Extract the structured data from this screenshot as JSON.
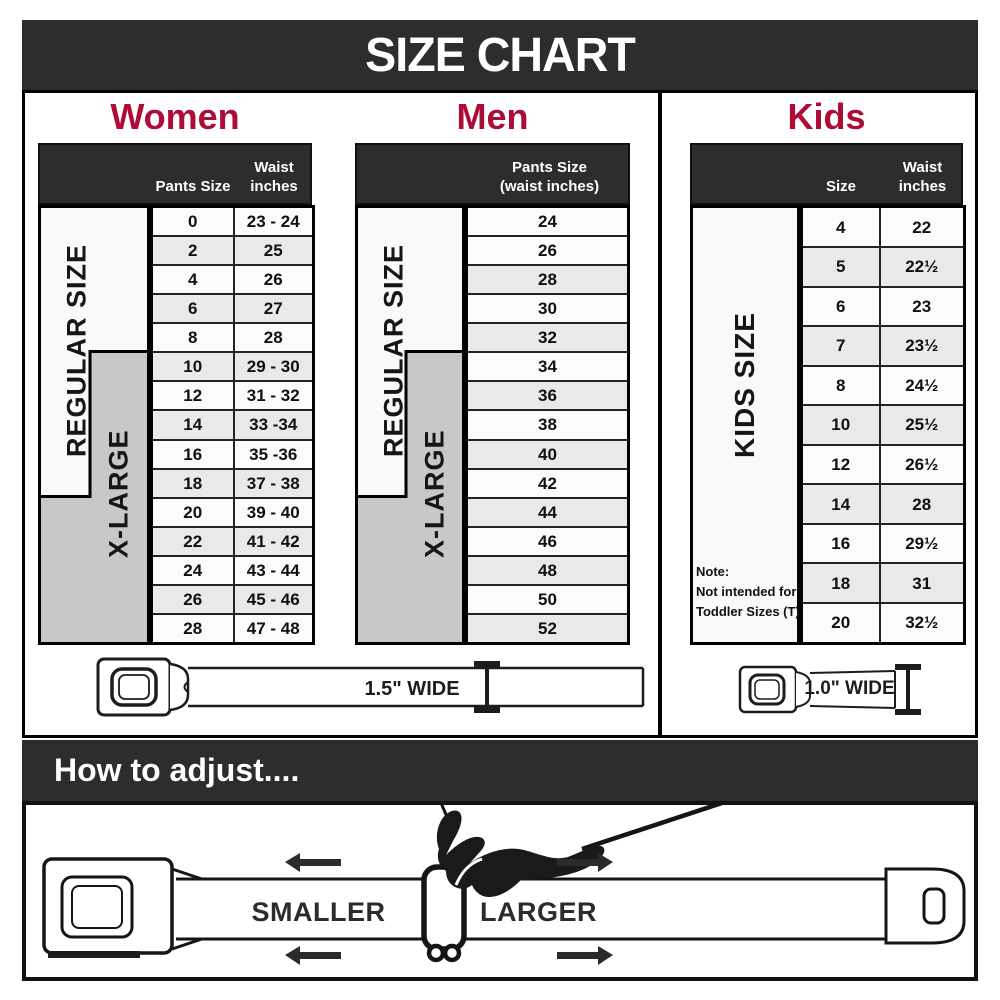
{
  "title": "SIZE CHART",
  "colors": {
    "dark_bar": "#2d2d2d",
    "heading_red": "#ae0c36",
    "row_alt": "#e9e9e9",
    "xlarge_gray": "#c8c8c8",
    "cell_border": "#242424"
  },
  "icons": {
    "buckle": "seatbelt-buckle",
    "width_marker": "i-beam-measure",
    "hand": "hand-pulling-strap",
    "arrows": "block-arrows-left-right"
  },
  "women": {
    "heading": "Women",
    "columns": {
      "pants_size": "Pants Size",
      "waist_line1": "Waist",
      "waist_line2": "inches"
    },
    "regular_label": "REGULAR SIZE",
    "xlarge_label": "X-LARGE",
    "rows": [
      {
        "size": "0",
        "waist": "23 - 24"
      },
      {
        "size": "2",
        "waist": "25"
      },
      {
        "size": "4",
        "waist": "26"
      },
      {
        "size": "6",
        "waist": "27"
      },
      {
        "size": "8",
        "waist": "28"
      },
      {
        "size": "10",
        "waist": "29 - 30"
      },
      {
        "size": "12",
        "waist": "31 - 32"
      },
      {
        "size": "14",
        "waist": "33 -34"
      },
      {
        "size": "16",
        "waist": "35 -36"
      },
      {
        "size": "18",
        "waist": "37 - 38"
      },
      {
        "size": "20",
        "waist": "39 - 40"
      },
      {
        "size": "22",
        "waist": "41 - 42"
      },
      {
        "size": "24",
        "waist": "43 - 44"
      },
      {
        "size": "26",
        "waist": "45 - 46"
      },
      {
        "size": "28",
        "waist": "47 - 48"
      }
    ],
    "belt_width_label": "1.5\" WIDE"
  },
  "men": {
    "heading": "Men",
    "columns": {
      "header_line1": "Pants Size",
      "header_line2": "(waist inches)"
    },
    "regular_label": "REGULAR SIZE",
    "xlarge_label": "X-LARGE",
    "rows": [
      "24",
      "26",
      "28",
      "30",
      "32",
      "34",
      "36",
      "38",
      "40",
      "42",
      "44",
      "46",
      "48",
      "50",
      "52"
    ]
  },
  "kids": {
    "heading": "Kids",
    "columns": {
      "size": "Size",
      "waist_line1": "Waist",
      "waist_line2": "inches"
    },
    "side_label": "KIDS SIZE",
    "note": {
      "line1": "Note:",
      "line2": "Not intended for",
      "line3": "Toddler Sizes (T)"
    },
    "rows": [
      {
        "size": "4",
        "waist": "22"
      },
      {
        "size": "5",
        "waist": "22½"
      },
      {
        "size": "6",
        "waist": "23"
      },
      {
        "size": "7",
        "waist": "23½"
      },
      {
        "size": "8",
        "waist": "24½"
      },
      {
        "size": "10",
        "waist": "25½"
      },
      {
        "size": "12",
        "waist": "26½"
      },
      {
        "size": "14",
        "waist": "28"
      },
      {
        "size": "16",
        "waist": "29½"
      },
      {
        "size": "18",
        "waist": "31"
      },
      {
        "size": "20",
        "waist": "32½"
      }
    ],
    "belt_width_label": "1.0\" WIDE"
  },
  "adjust": {
    "heading": "How to adjust....",
    "smaller_label": "SMALLER",
    "larger_label": "LARGER"
  },
  "chart_data": [
    {
      "type": "table",
      "title": "Women",
      "columns": [
        "Pants Size",
        "Waist inches"
      ],
      "rows": [
        [
          "0",
          "23 - 24"
        ],
        [
          "2",
          "25"
        ],
        [
          "4",
          "26"
        ],
        [
          "6",
          "27"
        ],
        [
          "8",
          "28"
        ],
        [
          "10",
          "29 - 30"
        ],
        [
          "12",
          "31 - 32"
        ],
        [
          "14",
          "33 -34"
        ],
        [
          "16",
          "35 -36"
        ],
        [
          "18",
          "37 - 38"
        ],
        [
          "20",
          "39 - 40"
        ],
        [
          "22",
          "41 - 42"
        ],
        [
          "24",
          "43 - 44"
        ],
        [
          "26",
          "45 - 46"
        ],
        [
          "28",
          "47 - 48"
        ]
      ],
      "annotations": [
        "REGULAR SIZE spans pants sizes 0-18",
        "X-LARGE spans pants sizes 10-28",
        "Belt is 1.5\" wide"
      ]
    },
    {
      "type": "table",
      "title": "Men",
      "columns": [
        "Pants Size (waist inches)"
      ],
      "rows": [
        [
          "24"
        ],
        [
          "26"
        ],
        [
          "28"
        ],
        [
          "30"
        ],
        [
          "32"
        ],
        [
          "34"
        ],
        [
          "36"
        ],
        [
          "38"
        ],
        [
          "40"
        ],
        [
          "42"
        ],
        [
          "44"
        ],
        [
          "46"
        ],
        [
          "48"
        ],
        [
          "50"
        ],
        [
          "52"
        ]
      ],
      "annotations": [
        "REGULAR SIZE spans 24-32",
        "X-LARGE spans 34-52",
        "Belt is 1.5\" wide"
      ]
    },
    {
      "type": "table",
      "title": "Kids",
      "columns": [
        "Size",
        "Waist inches"
      ],
      "rows": [
        [
          "4",
          "22"
        ],
        [
          "5",
          "22½"
        ],
        [
          "6",
          "23"
        ],
        [
          "7",
          "23½"
        ],
        [
          "8",
          "24½"
        ],
        [
          "10",
          "25½"
        ],
        [
          "12",
          "26½"
        ],
        [
          "14",
          "28"
        ],
        [
          "16",
          "29½"
        ],
        [
          "18",
          "31"
        ],
        [
          "20",
          "32½"
        ]
      ],
      "annotations": [
        "KIDS SIZE",
        "Note: Not intended for Toddler Sizes (T)",
        "Belt is 1.0\" wide"
      ]
    }
  ]
}
